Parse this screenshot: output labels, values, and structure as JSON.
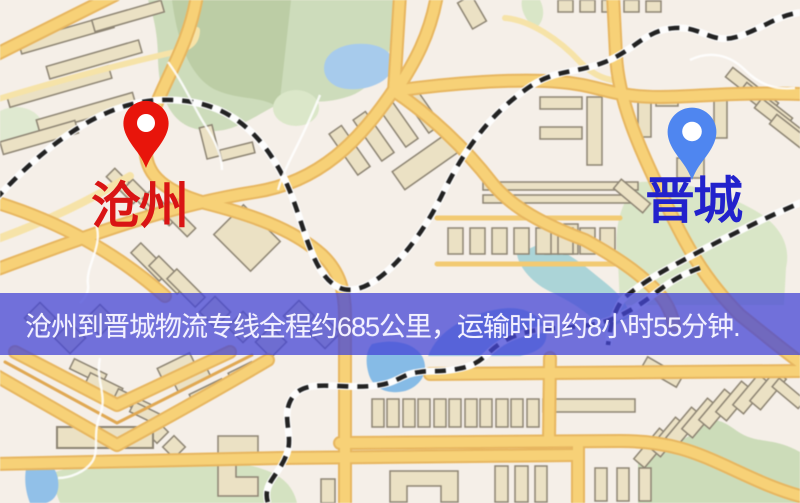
{
  "map": {
    "origin": {
      "label": "沧州",
      "marker_color": "#e8150b",
      "label_color": "#d91414"
    },
    "destination": {
      "label": "晋城",
      "marker_color": "#4f86f0",
      "label_color": "#2222cc"
    },
    "banner": {
      "text": "沧州到晋城物流专线全程约685公里，运输时间约8小时55分钟.",
      "overlay_color": "#4446d6",
      "text_color": "#f3f1ff"
    },
    "route": {
      "distance_km": 685,
      "duration_hours": 8,
      "duration_minutes": 55
    },
    "palette": {
      "map_background": "#f5efe8",
      "road_fill": "#f8d173",
      "road_border": "#e9b65c",
      "minor_road": "#f7e3a6",
      "railway": "#222222",
      "water": "#9cc6ec",
      "river": "#a9d3d6",
      "green_area": "#cfdfbb",
      "building_fill": "#ebe1c3",
      "building_border": "#8d8472"
    }
  }
}
